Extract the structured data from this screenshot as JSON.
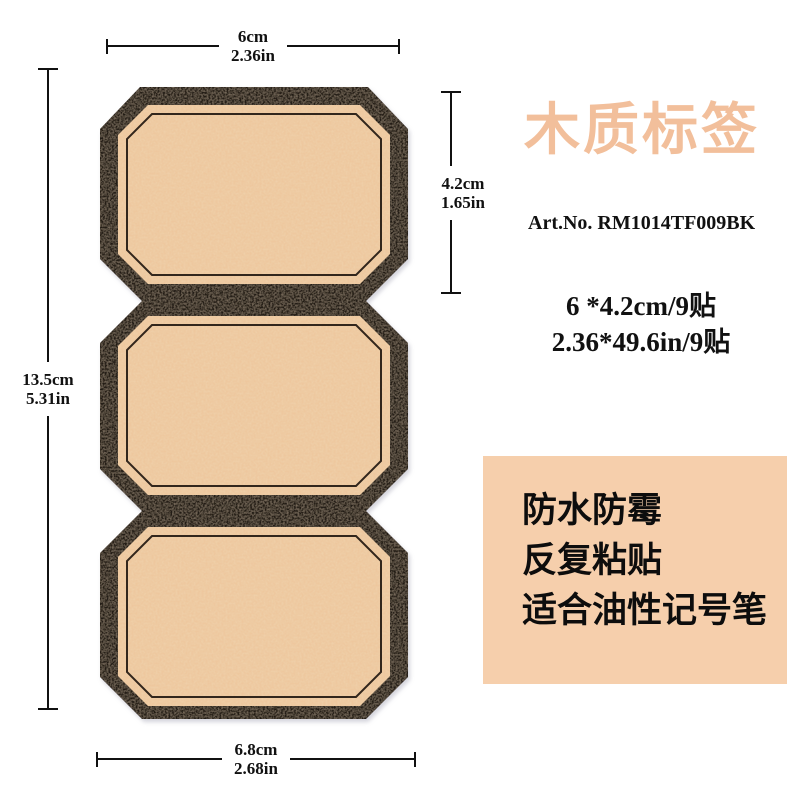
{
  "product": {
    "name": "cork-wood-label-sticker-sheet",
    "labels_count": 3,
    "colors": {
      "border": "#221b15",
      "border_speckle": "#5b4836",
      "cork": "#eec79e",
      "cork_speckle": "#dda66b",
      "inner_line": "#32261c"
    }
  },
  "dimensions": {
    "top": {
      "cm": "6cm",
      "in": "2.36in"
    },
    "right": {
      "cm": "4.2cm",
      "in": "1.65in"
    },
    "left": {
      "cm": "13.5cm",
      "in": "5.31in"
    },
    "bottom": {
      "cm": "6.8cm",
      "in": "2.68in"
    }
  },
  "info": {
    "title": "木质标签",
    "title_color": "#f2bf9b",
    "art_no": "Art.No. RM1014TF009BK",
    "spec_cm": "6 *4.2cm/9贴",
    "spec_in": "2.36*49.6in/9贴"
  },
  "features": {
    "bg_color": "#f6cfac",
    "lines": [
      "防水防霉",
      "反复粘贴",
      "适合油性记号笔"
    ]
  }
}
